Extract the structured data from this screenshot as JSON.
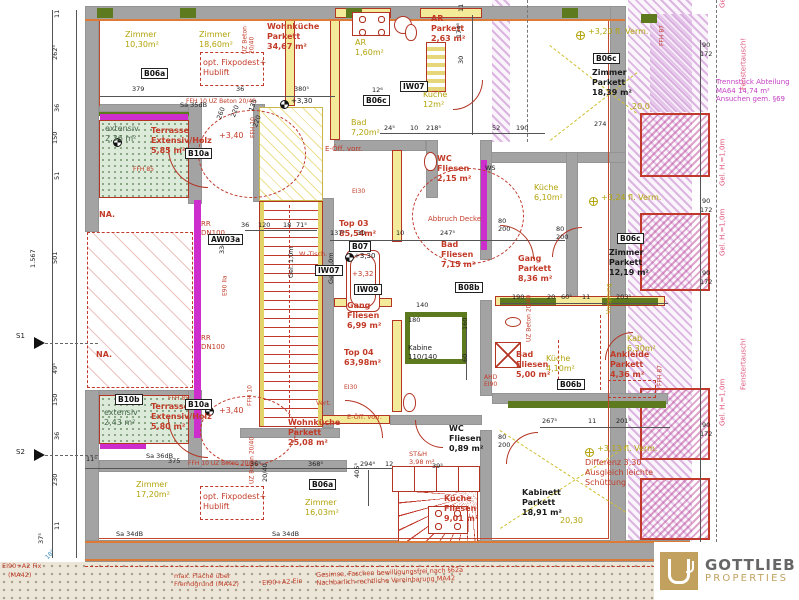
{
  "logo": {
    "name": "GOTTLIEB",
    "subtitle": "PROPERTIES"
  },
  "labels": [
    {
      "t": "Zimmer\n10,30m²",
      "x": 125,
      "y": 30,
      "c": "y",
      "n": "room-label-zimmer-1"
    },
    {
      "t": "Zimmer\n18,60m²",
      "x": 199,
      "y": 30,
      "c": "y",
      "n": "room-label-zimmer-2"
    },
    {
      "t": "Wohnküche\nParkett\n34,67 m²",
      "x": 267,
      "y": 22,
      "c": "r",
      "b": 1,
      "n": "room-label-wohnkueche-1"
    },
    {
      "t": "AR\n1,60m²",
      "x": 355,
      "y": 38,
      "c": "y"
    },
    {
      "t": "AR\nParkett\n2,63 m²",
      "x": 431,
      "y": 14,
      "c": "r",
      "b": 1
    },
    {
      "t": "Küche\n12m²",
      "x": 423,
      "y": 90,
      "c": "y"
    },
    {
      "t": "Bad\n7,20m²",
      "x": 351,
      "y": 118,
      "c": "y"
    },
    {
      "t": "+3,20 fl. Verm.",
      "x": 588,
      "y": 27,
      "c": "y"
    },
    {
      "t": "Zimmer\nParkett\n18,39 m²",
      "x": 592,
      "y": 68,
      "c": "k",
      "b": 1,
      "n": "room-label-zimmer-3"
    },
    {
      "t": "20,0",
      "x": 632,
      "y": 102,
      "c": "y"
    },
    {
      "t": "opt. Fixpodest+\nHublift",
      "x": 203,
      "y": 58,
      "c": "r"
    },
    {
      "t": "extensiv\n2,36 m²",
      "x": 105,
      "y": 124,
      "c": "g"
    },
    {
      "t": "Terrasse\nExtensiv/Holz\n5,85 m²",
      "x": 151,
      "y": 126,
      "c": "r",
      "b": 1,
      "n": "room-label-terrasse-1"
    },
    {
      "t": "+3,40",
      "x": 219,
      "y": 131,
      "c": "r"
    },
    {
      "t": "FFH 85",
      "x": 133,
      "y": 166,
      "c": "r",
      "fs": 6
    },
    {
      "t": "NA.",
      "x": 99,
      "y": 210,
      "c": "r",
      "b": 1
    },
    {
      "t": "NA.",
      "x": 96,
      "y": 350,
      "c": "r",
      "b": 1
    },
    {
      "t": "RR\nDN100",
      "x": 201,
      "y": 220,
      "c": "r",
      "fs": 7
    },
    {
      "t": "RR\nDN100",
      "x": 201,
      "y": 334,
      "c": "r",
      "fs": 7
    },
    {
      "t": "E-Öff. vorr.",
      "x": 325,
      "y": 145,
      "c": "r",
      "fs": 7
    },
    {
      "t": "WC\nFliesen\n2,15 m²",
      "x": 437,
      "y": 154,
      "c": "r",
      "b": 1
    },
    {
      "t": "Top 03\n85,54m²",
      "x": 339,
      "y": 219,
      "c": "r",
      "b": 1,
      "n": "unit-label-top03"
    },
    {
      "t": "Abbruch Decke",
      "x": 428,
      "y": 215,
      "c": "r",
      "fs": 7
    },
    {
      "t": "Bad\nFliesen\n7,15 m²",
      "x": 441,
      "y": 240,
      "c": "r",
      "b": 1
    },
    {
      "t": "W.-Tisch.",
      "x": 299,
      "y": 251,
      "c": "r",
      "fs": 6.5
    },
    {
      "t": "+3,30",
      "x": 354,
      "y": 252,
      "c": "k",
      "fs": 7
    },
    {
      "t": "+3,32",
      "x": 352,
      "y": 270,
      "c": "r",
      "fs": 7
    },
    {
      "t": "Gang\nFliesen\n6,99 m²",
      "x": 347,
      "y": 301,
      "c": "r",
      "b": 1
    },
    {
      "t": "Top 04\n63,98m²",
      "x": 344,
      "y": 348,
      "c": "r",
      "b": 1,
      "n": "unit-label-top04"
    },
    {
      "t": "Kabine\n110/140",
      "x": 408,
      "y": 344,
      "c": "k",
      "fs": 7
    },
    {
      "t": "Vert.",
      "x": 316,
      "y": 400,
      "c": "r",
      "fs": 6.5
    },
    {
      "t": "EI30",
      "x": 352,
      "y": 188,
      "c": "r",
      "fs": 6
    },
    {
      "t": "EI30",
      "x": 344,
      "y": 384,
      "c": "r",
      "fs": 6
    },
    {
      "t": "Küche\n6,10m²",
      "x": 534,
      "y": 183,
      "c": "y"
    },
    {
      "t": "+3,24 fl. Verm.",
      "x": 601,
      "y": 193,
      "c": "y"
    },
    {
      "t": "Gang\nParkett\n8,36 m²",
      "x": 518,
      "y": 254,
      "c": "r",
      "b": 1
    },
    {
      "t": "Zimmer\nParkett\n12,19 m²",
      "x": 609,
      "y": 248,
      "c": "k",
      "b": 1,
      "n": "room-label-zimmer-4"
    },
    {
      "t": "WS",
      "x": 485,
      "y": 165,
      "c": "k",
      "fs": 6.5
    },
    {
      "t": "Kab\n6,30m²",
      "x": 627,
      "y": 334,
      "c": "y"
    },
    {
      "t": "Vorsprung",
      "x": 613,
      "y": 314,
      "c": "y",
      "v": 1,
      "fs": 6
    },
    {
      "t": "Küche\n4,10m²",
      "x": 546,
      "y": 354,
      "c": "y"
    },
    {
      "t": "Bad\nFliesen\n5,00 m²",
      "x": 516,
      "y": 350,
      "c": "r",
      "b": 1
    },
    {
      "t": "Ankleide\nParkett\n4,36 m²",
      "x": 610,
      "y": 350,
      "c": "r",
      "b": 1
    },
    {
      "t": "AHD\nEI90",
      "x": 484,
      "y": 374,
      "c": "r",
      "fs": 6
    },
    {
      "t": "+3,13 fl. Verm.",
      "x": 597,
      "y": 444,
      "c": "y"
    },
    {
      "t": "Differenz 3,30\nAusgleich leichte\nSchüttung",
      "x": 585,
      "y": 458,
      "c": "r"
    },
    {
      "t": "Kabinett\nParkett\n18,91 m²",
      "x": 522,
      "y": 488,
      "c": "k",
      "b": 1,
      "n": "room-label-kabinett"
    },
    {
      "t": "20,30",
      "x": 560,
      "y": 516,
      "c": "y"
    },
    {
      "t": "Wohnküche\nParkett\n25,08 m²",
      "x": 288,
      "y": 418,
      "c": "r",
      "b": 1,
      "n": "room-label-wohnkueche-2"
    },
    {
      "t": "E-Öff. vorr.",
      "x": 347,
      "y": 414,
      "c": "r",
      "fs": 6.5
    },
    {
      "t": "ST&H\n3,98 m²",
      "x": 409,
      "y": 451,
      "c": "r",
      "fs": 6.5
    },
    {
      "t": "WC\nFliesen\n0,89 m²",
      "x": 449,
      "y": 424,
      "c": "k",
      "b": 1
    },
    {
      "t": "Küche\nFliesen\n9,01 m²",
      "x": 444,
      "y": 494,
      "c": "r",
      "b": 1
    },
    {
      "t": "extensiv\n2,43 m²",
      "x": 104,
      "y": 408,
      "c": "g"
    },
    {
      "t": "Terrasse\nExtensiv/Holz\n5,80 m²",
      "x": 151,
      "y": 402,
      "c": "r",
      "b": 1,
      "n": "room-label-terrasse-2"
    },
    {
      "t": "+3,40",
      "x": 219,
      "y": 406,
      "c": "r"
    },
    {
      "t": "FFH 85",
      "x": 168,
      "y": 395,
      "c": "r",
      "fs": 6
    },
    {
      "t": "Zimmer\n17,20m²",
      "x": 136,
      "y": 480,
      "c": "y"
    },
    {
      "t": "Zimmer\n16,03m²",
      "x": 305,
      "y": 498,
      "c": "y"
    },
    {
      "t": "opt. Fixpodest+\nHublift",
      "x": 203,
      "y": 492,
      "c": "r"
    },
    {
      "t": "Trennstück Abteilung\nMA64 14,74 m²\nAnsuchen gem. §69",
      "x": 716,
      "y": 78,
      "c": "m",
      "fs": 7
    },
    {
      "t": "Gel. H.=1,0m",
      "x": 727,
      "y": 8,
      "c": "p",
      "v": 1,
      "fs": 7
    },
    {
      "t": "Fenstertausch!",
      "x": 748,
      "y": 90,
      "c": "p",
      "v": 1,
      "fs": 7
    },
    {
      "t": "Gel. H.=1,0m",
      "x": 727,
      "y": 186,
      "c": "p",
      "v": 1,
      "fs": 7
    },
    {
      "t": "Gel. H.=1,0m",
      "x": 727,
      "y": 256,
      "c": "p",
      "v": 1,
      "fs": 7
    },
    {
      "t": "Fenstertausch!",
      "x": 748,
      "y": 390,
      "c": "p",
      "v": 1,
      "fs": 7
    },
    {
      "t": "Gel. H.=1,0m",
      "x": 727,
      "y": 426,
      "c": "p",
      "v": 1,
      "fs": 7
    },
    {
      "t": "FFH 87",
      "x": 666,
      "y": 46,
      "c": "r",
      "v": 1,
      "fs": 6
    },
    {
      "t": "FFH 87",
      "x": 664,
      "y": 386,
      "c": "r",
      "v": 1,
      "fs": 6
    },
    {
      "t": "FFH 10",
      "x": 257,
      "y": 138,
      "c": "r",
      "v": 1,
      "fs": 6
    },
    {
      "t": "FFH 10",
      "x": 254,
      "y": 406,
      "c": "r",
      "v": 1,
      "fs": 6
    },
    {
      "t": "UZ Beton\n20/40",
      "x": 256,
      "y": 54,
      "c": "r",
      "v": 1,
      "fs": 6
    },
    {
      "t": "FFH 10  UZ Beton 20/40",
      "x": 186,
      "y": 98,
      "c": "r",
      "fs": 6
    },
    {
      "t": "FFH 10  UZ Beton 20/40",
      "x": 188,
      "y": 460,
      "c": "r",
      "fs": 6
    },
    {
      "t": "UZ Beton 20/40",
      "x": 533,
      "y": 342,
      "c": "r",
      "v": 1,
      "fs": 6
    },
    {
      "t": "UZ Beton 20/40",
      "x": 256,
      "y": 484,
      "c": "r",
      "v": 1,
      "fs": 6
    },
    {
      "t": "E90 IIa",
      "x": 229,
      "y": 296,
      "c": "r",
      "v": 1,
      "fs": 6
    },
    {
      "t": "33dB",
      "x": 227,
      "y": 254,
      "c": "d",
      "v": 1
    },
    {
      "t": "Gel. 1,0m",
      "x": 296,
      "y": 278,
      "c": "d",
      "v": 1
    },
    {
      "t": "Gel. 1,0m",
      "x": 336,
      "y": 284,
      "c": "d",
      "v": 1
    },
    {
      "t": "Sa 35dB",
      "x": 180,
      "y": 102,
      "c": "d"
    },
    {
      "t": "Sa 36dB",
      "x": 146,
      "y": 453,
      "c": "d"
    },
    {
      "t": "Sa 34dB",
      "x": 116,
      "y": 531,
      "c": "d"
    },
    {
      "t": "Sa 34dB",
      "x": 272,
      "y": 531,
      "c": "d"
    },
    {
      "t": "B06a",
      "x": 141,
      "y": 68,
      "c": "bx"
    },
    {
      "t": "IW07",
      "x": 400,
      "y": 81,
      "c": "bx"
    },
    {
      "t": "B06c",
      "x": 363,
      "y": 95,
      "c": "bx"
    },
    {
      "t": "B06c",
      "x": 593,
      "y": 53,
      "c": "bx"
    },
    {
      "t": "B10a",
      "x": 185,
      "y": 148,
      "c": "bx"
    },
    {
      "t": "AW03a",
      "x": 208,
      "y": 234,
      "c": "bx"
    },
    {
      "t": "B07",
      "x": 349,
      "y": 241,
      "c": "bx"
    },
    {
      "t": "IW07",
      "x": 315,
      "y": 265,
      "c": "bx"
    },
    {
      "t": "IW09",
      "x": 354,
      "y": 284,
      "c": "bx"
    },
    {
      "t": "B08b",
      "x": 455,
      "y": 282,
      "c": "bx"
    },
    {
      "t": "B06c",
      "x": 617,
      "y": 233,
      "c": "bx"
    },
    {
      "t": "B06b",
      "x": 557,
      "y": 379,
      "c": "bx"
    },
    {
      "t": "B10b",
      "x": 115,
      "y": 394,
      "c": "bx"
    },
    {
      "t": "B10a",
      "x": 185,
      "y": 399,
      "c": "bx"
    },
    {
      "t": "B06a",
      "x": 309,
      "y": 479,
      "c": "bx"
    },
    {
      "t": "+3,30",
      "x": 291,
      "y": 97,
      "c": "k",
      "fs": 7
    },
    {
      "t": "S1",
      "x": 16,
      "y": 332,
      "c": "k",
      "fs": 7
    },
    {
      "t": "S2",
      "x": 16,
      "y": 448,
      "c": "k",
      "fs": 7
    },
    {
      "t": "18°",
      "x": 44,
      "y": 556,
      "c": "bl",
      "fs": 6,
      "r": -45
    },
    {
      "t": "1.567",
      "x": 38,
      "y": 268,
      "c": "d",
      "v": 1
    },
    {
      "t": "501",
      "x": 60,
      "y": 264,
      "c": "d",
      "v": 1
    },
    {
      "t": "11",
      "x": 62,
      "y": 18,
      "c": "d",
      "v": 1
    },
    {
      "t": "262⁵",
      "x": 60,
      "y": 60,
      "c": "d",
      "v": 1
    },
    {
      "t": "36",
      "x": 62,
      "y": 112,
      "c": "d",
      "v": 1
    },
    {
      "t": "150",
      "x": 60,
      "y": 144,
      "c": "d",
      "v": 1
    },
    {
      "t": "51",
      "x": 62,
      "y": 180,
      "c": "d",
      "v": 1
    },
    {
      "t": "49⁵",
      "x": 60,
      "y": 374,
      "c": "d",
      "v": 1
    },
    {
      "t": "150",
      "x": 60,
      "y": 406,
      "c": "d",
      "v": 1
    },
    {
      "t": "36",
      "x": 62,
      "y": 440,
      "c": "d",
      "v": 1
    },
    {
      "t": "230",
      "x": 60,
      "y": 486,
      "c": "d",
      "v": 1
    },
    {
      "t": "11",
      "x": 62,
      "y": 530,
      "c": "d",
      "v": 1
    },
    {
      "t": "37⁵",
      "x": 46,
      "y": 544,
      "c": "d",
      "v": 1
    },
    {
      "t": "379",
      "x": 132,
      "y": 86,
      "c": "d"
    },
    {
      "t": "36",
      "x": 236,
      "y": 86,
      "c": "d"
    },
    {
      "t": "380⁵",
      "x": 294,
      "y": 86,
      "c": "d"
    },
    {
      "t": "12⁶",
      "x": 372,
      "y": 87,
      "c": "d"
    },
    {
      "t": "24⁵",
      "x": 384,
      "y": 125,
      "c": "d"
    },
    {
      "t": "10",
      "x": 410,
      "y": 125,
      "c": "d"
    },
    {
      "t": "218⁵",
      "x": 426,
      "y": 125,
      "c": "d"
    },
    {
      "t": "11",
      "x": 466,
      "y": 12,
      "c": "d",
      "v": 1
    },
    {
      "t": "174⁵",
      "x": 464,
      "y": 38,
      "c": "d",
      "v": 1
    },
    {
      "t": "30",
      "x": 466,
      "y": 64,
      "c": "d",
      "v": 1
    },
    {
      "t": "52",
      "x": 492,
      "y": 125,
      "c": "d"
    },
    {
      "t": "190",
      "x": 516,
      "y": 125,
      "c": "d"
    },
    {
      "t": "274",
      "x": 594,
      "y": 121,
      "c": "d"
    },
    {
      "t": "90",
      "x": 702,
      "y": 42,
      "c": "d"
    },
    {
      "t": "172",
      "x": 700,
      "y": 51,
      "c": "d"
    },
    {
      "t": "90",
      "x": 702,
      "y": 198,
      "c": "d"
    },
    {
      "t": "172",
      "x": 700,
      "y": 207,
      "c": "d"
    },
    {
      "t": "90",
      "x": 702,
      "y": 270,
      "c": "d"
    },
    {
      "t": "172",
      "x": 700,
      "y": 279,
      "c": "d"
    },
    {
      "t": "90",
      "x": 702,
      "y": 422,
      "c": "d"
    },
    {
      "t": "172",
      "x": 700,
      "y": 431,
      "c": "d"
    },
    {
      "t": "137⁵",
      "x": 330,
      "y": 230,
      "c": "d"
    },
    {
      "t": "30",
      "x": 357,
      "y": 230,
      "c": "d"
    },
    {
      "t": "10",
      "x": 396,
      "y": 230,
      "c": "d"
    },
    {
      "t": "247⁵",
      "x": 440,
      "y": 230,
      "c": "d"
    },
    {
      "t": "36",
      "x": 241,
      "y": 222,
      "c": "d"
    },
    {
      "t": "120",
      "x": 258,
      "y": 222,
      "c": "d"
    },
    {
      "t": "18",
      "x": 283,
      "y": 222,
      "c": "d"
    },
    {
      "t": "71⁵",
      "x": 296,
      "y": 222,
      "c": "d"
    },
    {
      "t": "190",
      "x": 512,
      "y": 294,
      "c": "d"
    },
    {
      "t": "20",
      "x": 547,
      "y": 294,
      "c": "d"
    },
    {
      "t": "60⁵",
      "x": 561,
      "y": 294,
      "c": "d"
    },
    {
      "t": "11",
      "x": 582,
      "y": 294,
      "c": "d"
    },
    {
      "t": "203⁵",
      "x": 616,
      "y": 294,
      "c": "d"
    },
    {
      "t": "267⁵",
      "x": 542,
      "y": 418,
      "c": "d"
    },
    {
      "t": "11",
      "x": 588,
      "y": 418,
      "c": "d"
    },
    {
      "t": "201⁵",
      "x": 616,
      "y": 418,
      "c": "d"
    },
    {
      "t": "368⁵",
      "x": 308,
      "y": 461,
      "c": "d"
    },
    {
      "t": "294⁴",
      "x": 360,
      "y": 461,
      "c": "d"
    },
    {
      "t": "12",
      "x": 385,
      "y": 461,
      "c": "d"
    },
    {
      "t": "39⁵",
      "x": 432,
      "y": 463,
      "c": "d"
    },
    {
      "t": "375",
      "x": 168,
      "y": 458,
      "c": "d"
    },
    {
      "t": "11⁵",
      "x": 86,
      "y": 456,
      "c": "d"
    },
    {
      "t": "36⁵",
      "x": 250,
      "y": 461,
      "c": "d"
    },
    {
      "t": "405⁵",
      "x": 362,
      "y": 478,
      "c": "d",
      "v": 1
    },
    {
      "t": "140",
      "x": 416,
      "y": 302,
      "c": "d"
    },
    {
      "t": "180",
      "x": 408,
      "y": 317,
      "c": "d"
    },
    {
      "t": "160",
      "x": 470,
      "y": 330,
      "c": "d",
      "v": 1
    },
    {
      "t": "60",
      "x": 470,
      "y": 362,
      "c": "d",
      "v": 1
    },
    {
      "t": "80\n200",
      "x": 498,
      "y": 218,
      "c": "d"
    },
    {
      "t": "80\n200",
      "x": 556,
      "y": 226,
      "c": "d"
    },
    {
      "t": "80\n200",
      "x": 498,
      "y": 434,
      "c": "d"
    },
    {
      "t": "20/40",
      "x": 270,
      "y": 482,
      "c": "d",
      "v": 1
    },
    {
      "t": "260",
      "x": 216,
      "y": 118,
      "c": "d",
      "r": -70
    },
    {
      "t": "220",
      "x": 230,
      "y": 116,
      "c": "d",
      "r": -70
    },
    {
      "t": "135",
      "x": 248,
      "y": 110,
      "c": "d",
      "r": -70
    },
    {
      "t": "220",
      "x": 252,
      "y": 126,
      "c": "d",
      "r": -70
    },
    {
      "t": "max. Fläche über\nFremdgrund (MA42)",
      "x": 174,
      "y": 573,
      "c": "r",
      "fs": 6.5
    },
    {
      "t": "EI90+A2 Ein",
      "x": 262,
      "y": 580,
      "c": "r",
      "fs": 6.5,
      "r": -3
    },
    {
      "t": "Gesimse, Faschen bewilligungsfrei nach §62a\nNachbarlich rechtliche Vereinbarung MA42",
      "x": 316,
      "y": 572,
      "c": "r",
      "fs": 6.5,
      "r": -2
    },
    {
      "t": "EI90+A2 Fix",
      "x": 2,
      "y": 563,
      "c": "r",
      "fs": 6.5
    },
    {
      "t": "(MA42)",
      "x": 8,
      "y": 572,
      "c": "r",
      "fs": 6.5
    }
  ]
}
